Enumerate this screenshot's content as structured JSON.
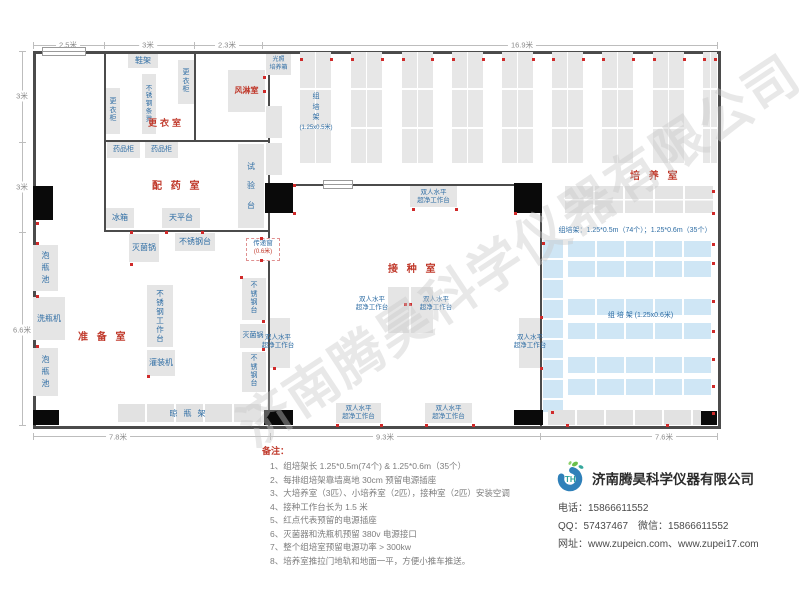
{
  "dims": {
    "top": [
      "2.5米",
      "3米",
      "2.3米",
      "16.9米"
    ],
    "left": [
      "3米",
      "3米",
      "6.6米"
    ],
    "bottom": [
      "7.8米",
      "9.3米",
      "7.6米"
    ]
  },
  "rooms": {
    "changing": "更衣室",
    "air_shower": "风淋室",
    "pharmacy": "配 药 室",
    "prep": "准 备 室",
    "inoculation": "接 种 室",
    "culture": "培 养 室"
  },
  "equipment": {
    "shoe_rack": "鞋架",
    "locker": "更衣柜",
    "steel_stool": "不锈钢条凳",
    "light_incubator_1": "光照",
    "light_incubator_2": "培养箱",
    "rack_v": "组培架",
    "rack_v_size": "(1.25x0.5米)",
    "medicine_cabinet": "药品柜",
    "fridge": "冰箱",
    "balance": "天平台",
    "test_bench": "试验台",
    "soak_pool": "泡瓶池",
    "washer": "洗瓶机",
    "sterilizer": "灭菌锅",
    "steel_table": "不锈钢台",
    "steel_workbench": "不锈钢工作台",
    "filler": "灌装机",
    "drain_rack": "晾瓶架",
    "pass_window": "传递窗",
    "pass_window_size": "(0.6米)",
    "clean_bench_1": "双人水平",
    "clean_bench_2": "超净工作台",
    "rack_h": "组 培 架",
    "rack_h_size": "(1.25x0.6米)",
    "rack_spec": "组培架：1.25*0.5m（74个）；1.25*0.6m（35个）"
  },
  "notes": {
    "title": "备注：",
    "items": [
      "1、组培架长 1.25*0.5m(74个) & 1.25*0.6m（35个）",
      "2、每排组培架靠墙离地 30cm 预留电源插座",
      "3、大培养室（3匹）、小培养室（2匹），接种室（2匹）安装空调",
      "4、接种工作台长为 1.5 米",
      "5、红点代表预留的电源插座",
      "6、灭菌器和洗瓶机预留 380v 电源接口",
      "7、整个组培室预留电源功率 > 300kw",
      "8、培养室推拉门地轨和地面一平，方便小推车推送。"
    ]
  },
  "company": {
    "name": "济南腾昊科学仪器有限公司",
    "logo_text": "TH",
    "phone": "电话：15866611552",
    "qq_wechat": "QQ：57437467　微信：15866611552",
    "website": "网址：www.zupeicn.com、www.zupei17.com"
  },
  "watermark": "济南腾昊科学仪器有限公司",
  "colors": {
    "room_label_red": "#c0392b",
    "equip_label_blue": "#2e6da4",
    "rack_blue": "#cfe6f5",
    "block_gray": "#e5e5e5",
    "socket_red": "#d02a2a",
    "wall_dark": "#4b4b4b"
  }
}
